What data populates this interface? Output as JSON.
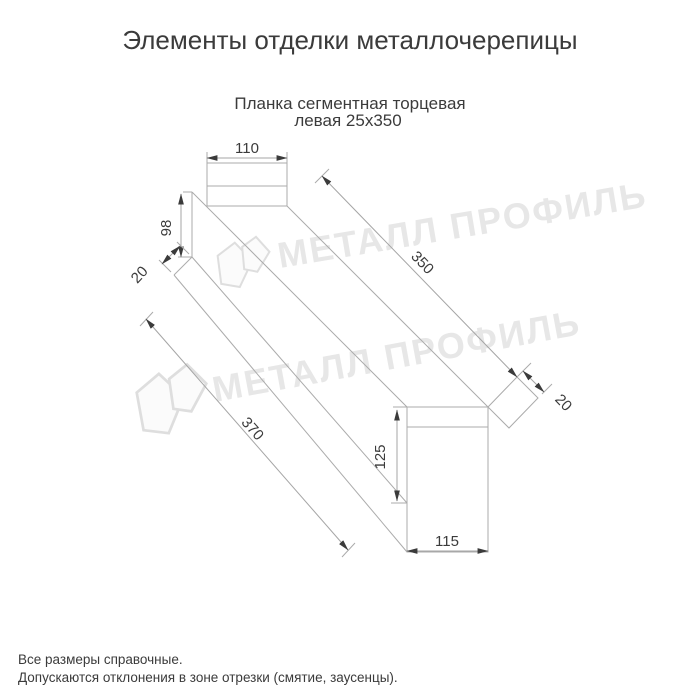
{
  "header": {
    "title": "Элементы отделки металлочерепицы",
    "subtitle_line1": "Планка сегментная торцевая",
    "subtitle_line2": "левая 25х350"
  },
  "diagram": {
    "part_name": "Планка сегментная торцевая левая 25х350",
    "dimensions": {
      "near_tab_width": "110",
      "near_height": "98",
      "near_hem": "20",
      "edge_length_top": "350",
      "edge_length_bottom": "370",
      "far_hem": "20",
      "far_tab_height": "125",
      "far_tab_width": "115"
    }
  },
  "watermark": {
    "text": "МЕТАЛЛ ПРОФИЛЬ"
  },
  "footer": {
    "line1": "Все размеры справочные.",
    "line2": "Допускаются отклонения в зоне отрезки (смятие, заусенцы)."
  },
  "colors": {
    "background": "#ffffff",
    "line": "#ababab",
    "text": "#3b3b3b",
    "watermark": "#e7e7e7"
  }
}
